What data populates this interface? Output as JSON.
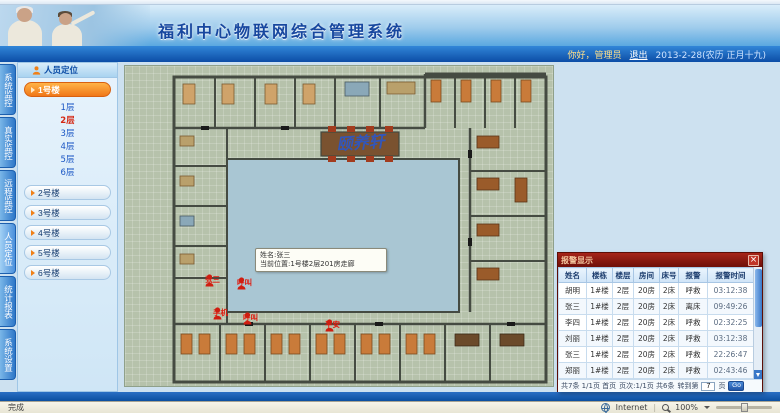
{
  "header": {
    "title": "福利中心物联网综合管理系统",
    "greeting": "你好，管理员",
    "logout": "退出",
    "date": "2013-2-28(农历 正月十九)"
  },
  "nav": {
    "tabs": [
      {
        "label": "系统监控"
      },
      {
        "label": "真实监控"
      },
      {
        "label": "远程监控"
      },
      {
        "label": "人员定位",
        "active": true
      },
      {
        "label": "统计报表"
      },
      {
        "label": "系统设置"
      }
    ]
  },
  "sidebar": {
    "title": "人员定位",
    "buildings": [
      {
        "label": "1号楼",
        "active": true
      },
      {
        "label": "2号楼"
      },
      {
        "label": "3号楼"
      },
      {
        "label": "4号楼"
      },
      {
        "label": "5号楼"
      },
      {
        "label": "6号楼"
      }
    ],
    "floors": [
      {
        "label": "1层"
      },
      {
        "label": "2层",
        "selected": true
      },
      {
        "label": "3层"
      },
      {
        "label": "4层"
      },
      {
        "label": "5层"
      },
      {
        "label": "6层"
      }
    ]
  },
  "floorplan": {
    "building_name": "颐养轩",
    "tooltip": {
      "line1": "姓名:张三",
      "line2": "当前位置:1号楼2层201房走廊"
    },
    "markers": [
      {
        "x": 80,
        "y": 208,
        "label": "张三"
      },
      {
        "x": 112,
        "y": 211,
        "label": "呼叫"
      },
      {
        "x": 88,
        "y": 241,
        "label": "手机"
      },
      {
        "x": 118,
        "y": 246,
        "label": "呼叫"
      },
      {
        "x": 200,
        "y": 253,
        "label": "平安"
      }
    ]
  },
  "popup": {
    "title": "报警显示",
    "close": "×",
    "columns": [
      "姓名",
      "楼栋",
      "楼层",
      "房间",
      "床号",
      "报警",
      "报警时间"
    ],
    "rows": [
      [
        "胡明",
        "1#楼",
        "2层",
        "20房",
        "2床",
        "呼救",
        "03:12:38"
      ],
      [
        "张三",
        "1#楼",
        "2层",
        "20房",
        "2床",
        "离床",
        "09:49:26"
      ],
      [
        "李四",
        "1#楼",
        "2层",
        "20房",
        "2床",
        "呼救",
        "02:32:25"
      ],
      [
        "刘丽",
        "1#楼",
        "2层",
        "20房",
        "2床",
        "呼救",
        "03:12:38"
      ],
      [
        "张三",
        "1#楼",
        "2层",
        "20房",
        "2床",
        "呼救",
        "22:26:47"
      ],
      [
        "郑丽",
        "1#楼",
        "2层",
        "20房",
        "2床",
        "呼救",
        "02:43:46"
      ]
    ],
    "pagination": {
      "summary": "共7条 1/1页 首页",
      "pageinfo": "页次:1/1页 共6条",
      "goto_label": "转到第",
      "page_value": "7",
      "unit": "页",
      "go": "Go"
    }
  },
  "browser": {
    "status_left": "完成",
    "zone": "Internet",
    "zoom_level": "100%"
  }
}
